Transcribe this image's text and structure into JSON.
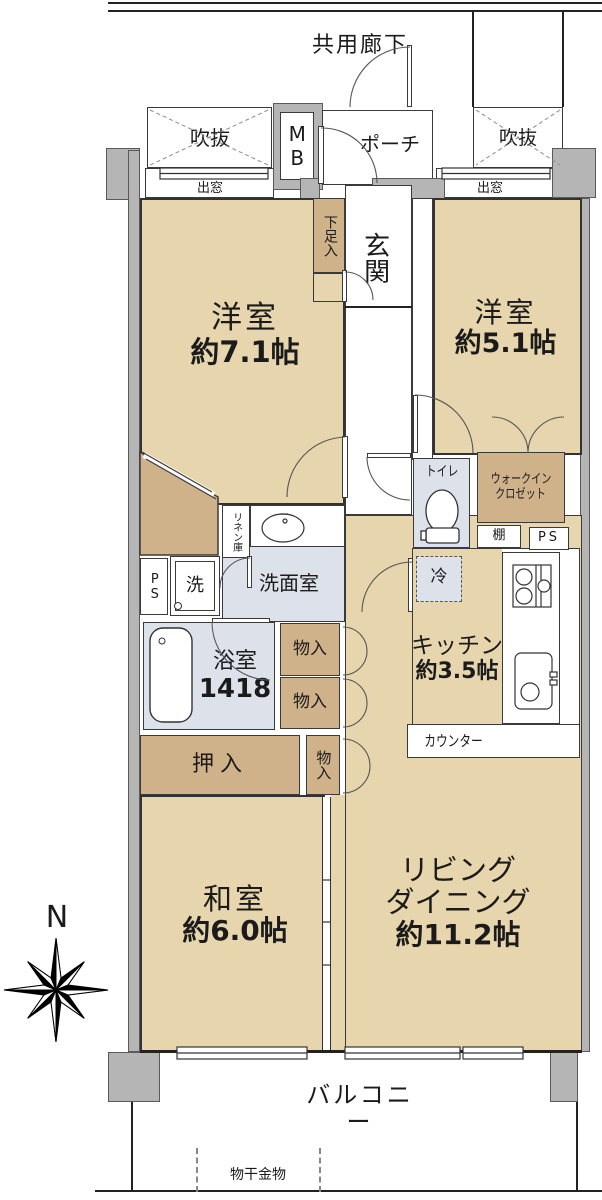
{
  "meta": {
    "type": "apartment-floor-plan",
    "compass": "N"
  },
  "colors": {
    "room_fill": "#e7d6ad",
    "storage_fill": "#cfb28a",
    "wet_area_fill": "#dde1ea",
    "wall_fill": "#b5b5b5",
    "line": "#333333"
  },
  "exterior": {
    "common_corridor": "共用廊下",
    "void_left": "吹抜",
    "void_right": "吹抜",
    "bay_window_left": "出窓",
    "bay_window_right": "出窓",
    "meter_box": "MB",
    "porch": "ポーチ",
    "balcony": "バルコニー",
    "laundry_hardware": "物干金物"
  },
  "entrance": {
    "genkan": "玄関",
    "shoe_cabinet": "下足入"
  },
  "rooms": {
    "western_room_1": {
      "name": "洋室",
      "size": "約7.1帖"
    },
    "western_room_2": {
      "name": "洋室",
      "size": "約5.1帖"
    },
    "japanese_room": {
      "name": "和室",
      "size": "約6.0帖"
    },
    "living_dining": {
      "line1": "リビング",
      "line2": "ダイニング",
      "size": "約11.2帖"
    },
    "kitchen": {
      "name": "キッチン",
      "size": "約3.5帖"
    }
  },
  "wet_areas": {
    "toilet": "トイレ",
    "washroom": "洗面室",
    "bathroom": {
      "name": "浴室",
      "size": "1418"
    },
    "washer": "洗",
    "fridge": "冷"
  },
  "storage": {
    "wic_left": {
      "line1": "ウォークイン",
      "line2": "クロゼット"
    },
    "wic_right": {
      "line1": "ウォークイン",
      "line2": "クロゼット"
    },
    "oshiire": "押入",
    "storage_1": "物入",
    "storage_2": "物入",
    "storage_3": "物入",
    "linen": "リネン庫",
    "shelf": "棚",
    "counter": "カウンター",
    "ps_left": "PS",
    "ps_right": "PS"
  }
}
